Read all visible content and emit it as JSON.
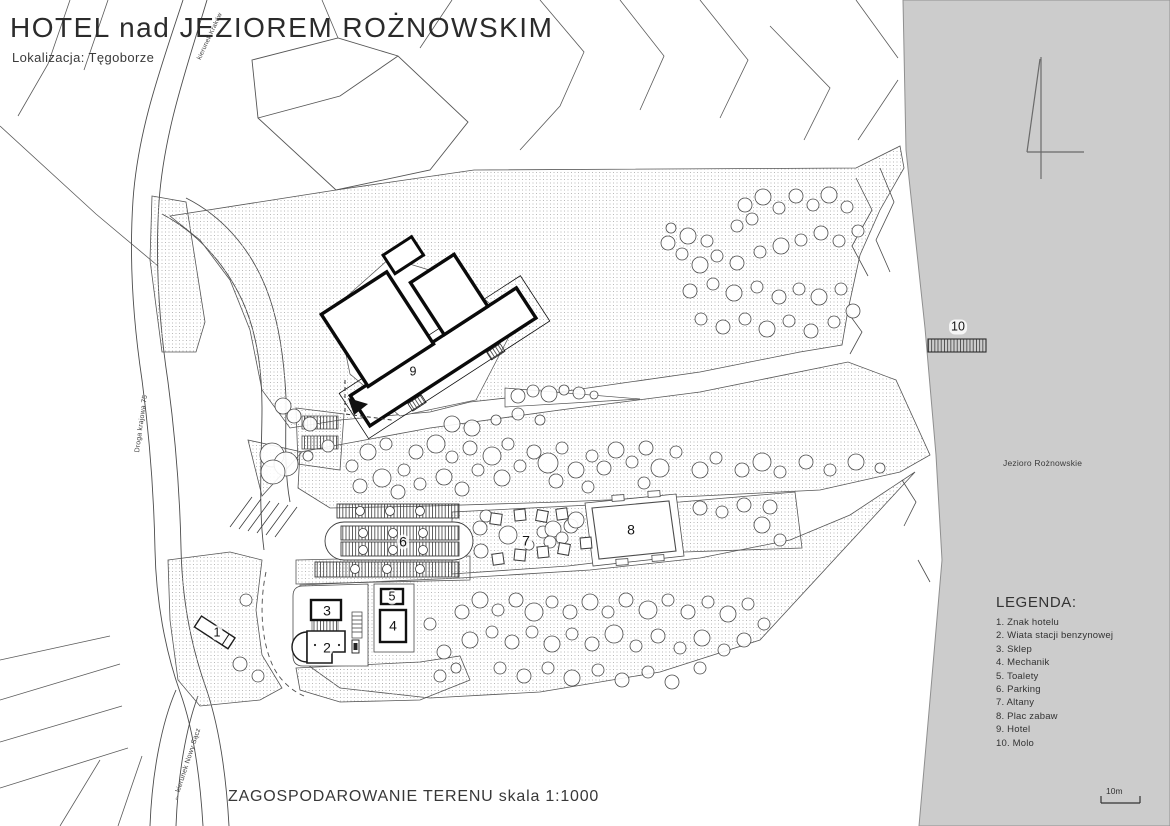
{
  "header": {
    "title": "HOTEL nad JEZIOREM ROŻNOWSKIM",
    "subtitle": "Lokalizacja: Tęgoborze"
  },
  "footer": {
    "caption": "ZAGOSPODAROWANIE TERENU skala 1:1000"
  },
  "legend": {
    "title": "LEGENDA:",
    "items": [
      "1. Znak hotelu",
      "2. Wiata stacji benzynowej",
      "3. Sklep",
      "4. Mechanik",
      "5. Toalety",
      "6. Parking",
      "7. Altany",
      "8. Plac zabaw",
      "9. Hotel",
      "10. Molo"
    ]
  },
  "map": {
    "lake_label": "Jezioro Rożnowskie",
    "scale_label": "10m",
    "numbers": [
      "1",
      "2",
      "3",
      "4",
      "5",
      "6",
      "7",
      "8",
      "9",
      "10"
    ],
    "road_labels": {
      "north": "kierunek Kraków",
      "highway": "Droga krajowa 75",
      "south": "← kierunek Nowy Sącz"
    }
  },
  "colors": {
    "lake": "#cccccc",
    "line": "#2e2e2e",
    "stipple": "#a8a8a8"
  },
  "map_symbols": {
    "trees": [
      [
        668,
        243,
        7
      ],
      [
        688,
        236,
        8
      ],
      [
        707,
        241,
        6
      ],
      [
        682,
        254,
        6
      ],
      [
        745,
        205,
        7
      ],
      [
        763,
        197,
        8
      ],
      [
        779,
        208,
        6
      ],
      [
        752,
        219,
        6
      ],
      [
        796,
        196,
        7
      ],
      [
        813,
        205,
        6
      ],
      [
        829,
        195,
        8
      ],
      [
        847,
        207,
        6
      ],
      [
        700,
        265,
        8
      ],
      [
        717,
        256,
        6
      ],
      [
        737,
        263,
        7
      ],
      [
        760,
        252,
        6
      ],
      [
        781,
        246,
        8
      ],
      [
        801,
        240,
        6
      ],
      [
        821,
        233,
        7
      ],
      [
        839,
        241,
        6
      ],
      [
        858,
        231,
        6
      ],
      [
        690,
        291,
        7
      ],
      [
        713,
        284,
        6
      ],
      [
        734,
        293,
        8
      ],
      [
        757,
        287,
        6
      ],
      [
        779,
        297,
        7
      ],
      [
        799,
        289,
        6
      ],
      [
        819,
        297,
        8
      ],
      [
        841,
        289,
        6
      ],
      [
        701,
        319,
        6
      ],
      [
        723,
        327,
        7
      ],
      [
        745,
        319,
        6
      ],
      [
        767,
        329,
        8
      ],
      [
        789,
        321,
        6
      ],
      [
        811,
        331,
        7
      ],
      [
        834,
        322,
        6
      ],
      [
        853,
        311,
        7
      ],
      [
        737,
        226,
        6
      ],
      [
        671,
        228,
        5
      ],
      [
        352,
        466,
        6
      ],
      [
        368,
        452,
        8
      ],
      [
        386,
        444,
        6
      ],
      [
        360,
        486,
        7
      ],
      [
        382,
        478,
        9
      ],
      [
        404,
        470,
        6
      ],
      [
        398,
        492,
        7
      ],
      [
        420,
        484,
        6
      ],
      [
        416,
        452,
        7
      ],
      [
        436,
        444,
        9
      ],
      [
        452,
        457,
        6
      ],
      [
        444,
        477,
        8
      ],
      [
        462,
        489,
        7
      ],
      [
        478,
        470,
        6
      ],
      [
        470,
        448,
        7
      ],
      [
        492,
        456,
        9
      ],
      [
        508,
        444,
        6
      ],
      [
        502,
        478,
        8
      ],
      [
        520,
        466,
        6
      ],
      [
        534,
        452,
        7
      ],
      [
        548,
        463,
        10
      ],
      [
        562,
        448,
        6
      ],
      [
        556,
        481,
        7
      ],
      [
        576,
        470,
        8
      ],
      [
        592,
        456,
        6
      ],
      [
        604,
        468,
        7
      ],
      [
        588,
        487,
        6
      ],
      [
        616,
        450,
        8
      ],
      [
        632,
        462,
        6
      ],
      [
        646,
        448,
        7
      ],
      [
        660,
        468,
        9
      ],
      [
        644,
        483,
        6
      ],
      [
        676,
        452,
        6
      ],
      [
        700,
        470,
        8
      ],
      [
        716,
        458,
        6
      ],
      [
        742,
        470,
        7
      ],
      [
        762,
        462,
        9
      ],
      [
        780,
        472,
        6
      ],
      [
        806,
        462,
        7
      ],
      [
        830,
        470,
        6
      ],
      [
        856,
        462,
        8
      ],
      [
        880,
        468,
        5
      ],
      [
        496,
        420,
        5
      ],
      [
        518,
        414,
        6
      ],
      [
        540,
        420,
        5
      ],
      [
        462,
        612,
        7
      ],
      [
        480,
        600,
        8
      ],
      [
        498,
        610,
        6
      ],
      [
        516,
        600,
        7
      ],
      [
        534,
        612,
        9
      ],
      [
        552,
        602,
        6
      ],
      [
        570,
        612,
        7
      ],
      [
        590,
        602,
        8
      ],
      [
        608,
        612,
        6
      ],
      [
        626,
        600,
        7
      ],
      [
        648,
        610,
        9
      ],
      [
        668,
        600,
        6
      ],
      [
        688,
        612,
        7
      ],
      [
        708,
        602,
        6
      ],
      [
        728,
        614,
        8
      ],
      [
        748,
        604,
        6
      ],
      [
        470,
        640,
        8
      ],
      [
        492,
        632,
        6
      ],
      [
        512,
        642,
        7
      ],
      [
        532,
        632,
        6
      ],
      [
        552,
        644,
        8
      ],
      [
        572,
        634,
        6
      ],
      [
        592,
        644,
        7
      ],
      [
        614,
        634,
        9
      ],
      [
        636,
        646,
        6
      ],
      [
        658,
        636,
        7
      ],
      [
        680,
        648,
        6
      ],
      [
        702,
        638,
        8
      ],
      [
        724,
        650,
        6
      ],
      [
        744,
        640,
        7
      ],
      [
        500,
        668,
        6
      ],
      [
        524,
        676,
        7
      ],
      [
        548,
        668,
        6
      ],
      [
        572,
        678,
        8
      ],
      [
        598,
        670,
        6
      ],
      [
        622,
        680,
        7
      ],
      [
        648,
        672,
        6
      ],
      [
        672,
        682,
        7
      ],
      [
        430,
        624,
        6
      ],
      [
        444,
        652,
        7
      ],
      [
        764,
        624,
        6
      ],
      [
        700,
        668,
        6
      ],
      [
        246,
        600,
        6
      ],
      [
        240,
        664,
        7
      ],
      [
        258,
        676,
        6
      ],
      [
        440,
        676,
        6
      ],
      [
        456,
        668,
        5
      ],
      [
        310,
        424,
        7
      ],
      [
        328,
        446,
        6
      ],
      [
        308,
        456,
        5
      ],
      [
        283,
        406,
        8
      ],
      [
        294,
        416,
        7
      ],
      [
        272,
        455,
        12
      ],
      [
        286,
        464,
        12
      ],
      [
        273,
        472,
        12
      ],
      [
        452,
        424,
        8
      ],
      [
        472,
        428,
        8
      ],
      [
        518,
        396,
        7
      ],
      [
        533,
        391,
        6
      ],
      [
        549,
        394,
        8
      ],
      [
        564,
        390,
        5
      ],
      [
        579,
        393,
        6
      ],
      [
        594,
        395,
        4
      ],
      [
        480,
        528,
        7
      ],
      [
        486,
        516,
        6
      ],
      [
        508,
        535,
        9
      ],
      [
        543,
        532,
        6
      ],
      [
        553,
        529,
        8
      ],
      [
        571,
        526,
        7
      ],
      [
        562,
        538,
        6
      ],
      [
        481,
        551,
        7
      ],
      [
        529,
        545,
        5
      ],
      [
        550,
        542,
        6
      ],
      [
        576,
        520,
        8
      ],
      [
        762,
        525,
        8
      ],
      [
        770,
        507,
        7
      ],
      [
        780,
        540,
        6
      ],
      [
        700,
        508,
        7
      ],
      [
        722,
        512,
        6
      ],
      [
        744,
        505,
        7
      ]
    ],
    "gazebos": [
      [
        496,
        519,
        8
      ],
      [
        520,
        515,
        -6
      ],
      [
        542,
        516,
        10
      ],
      [
        562,
        514,
        -8
      ],
      [
        498,
        559,
        -8
      ],
      [
        520,
        555,
        6
      ],
      [
        543,
        552,
        -6
      ],
      [
        564,
        549,
        10
      ],
      [
        586,
        543,
        -5
      ]
    ],
    "parking_trees": [
      [
        360,
        511
      ],
      [
        390,
        511
      ],
      [
        420,
        511
      ],
      [
        363,
        533
      ],
      [
        393,
        533
      ],
      [
        423,
        533
      ],
      [
        363,
        550
      ],
      [
        393,
        550
      ],
      [
        423,
        550
      ],
      [
        355,
        569
      ],
      [
        387,
        569
      ],
      [
        420,
        569
      ]
    ]
  }
}
